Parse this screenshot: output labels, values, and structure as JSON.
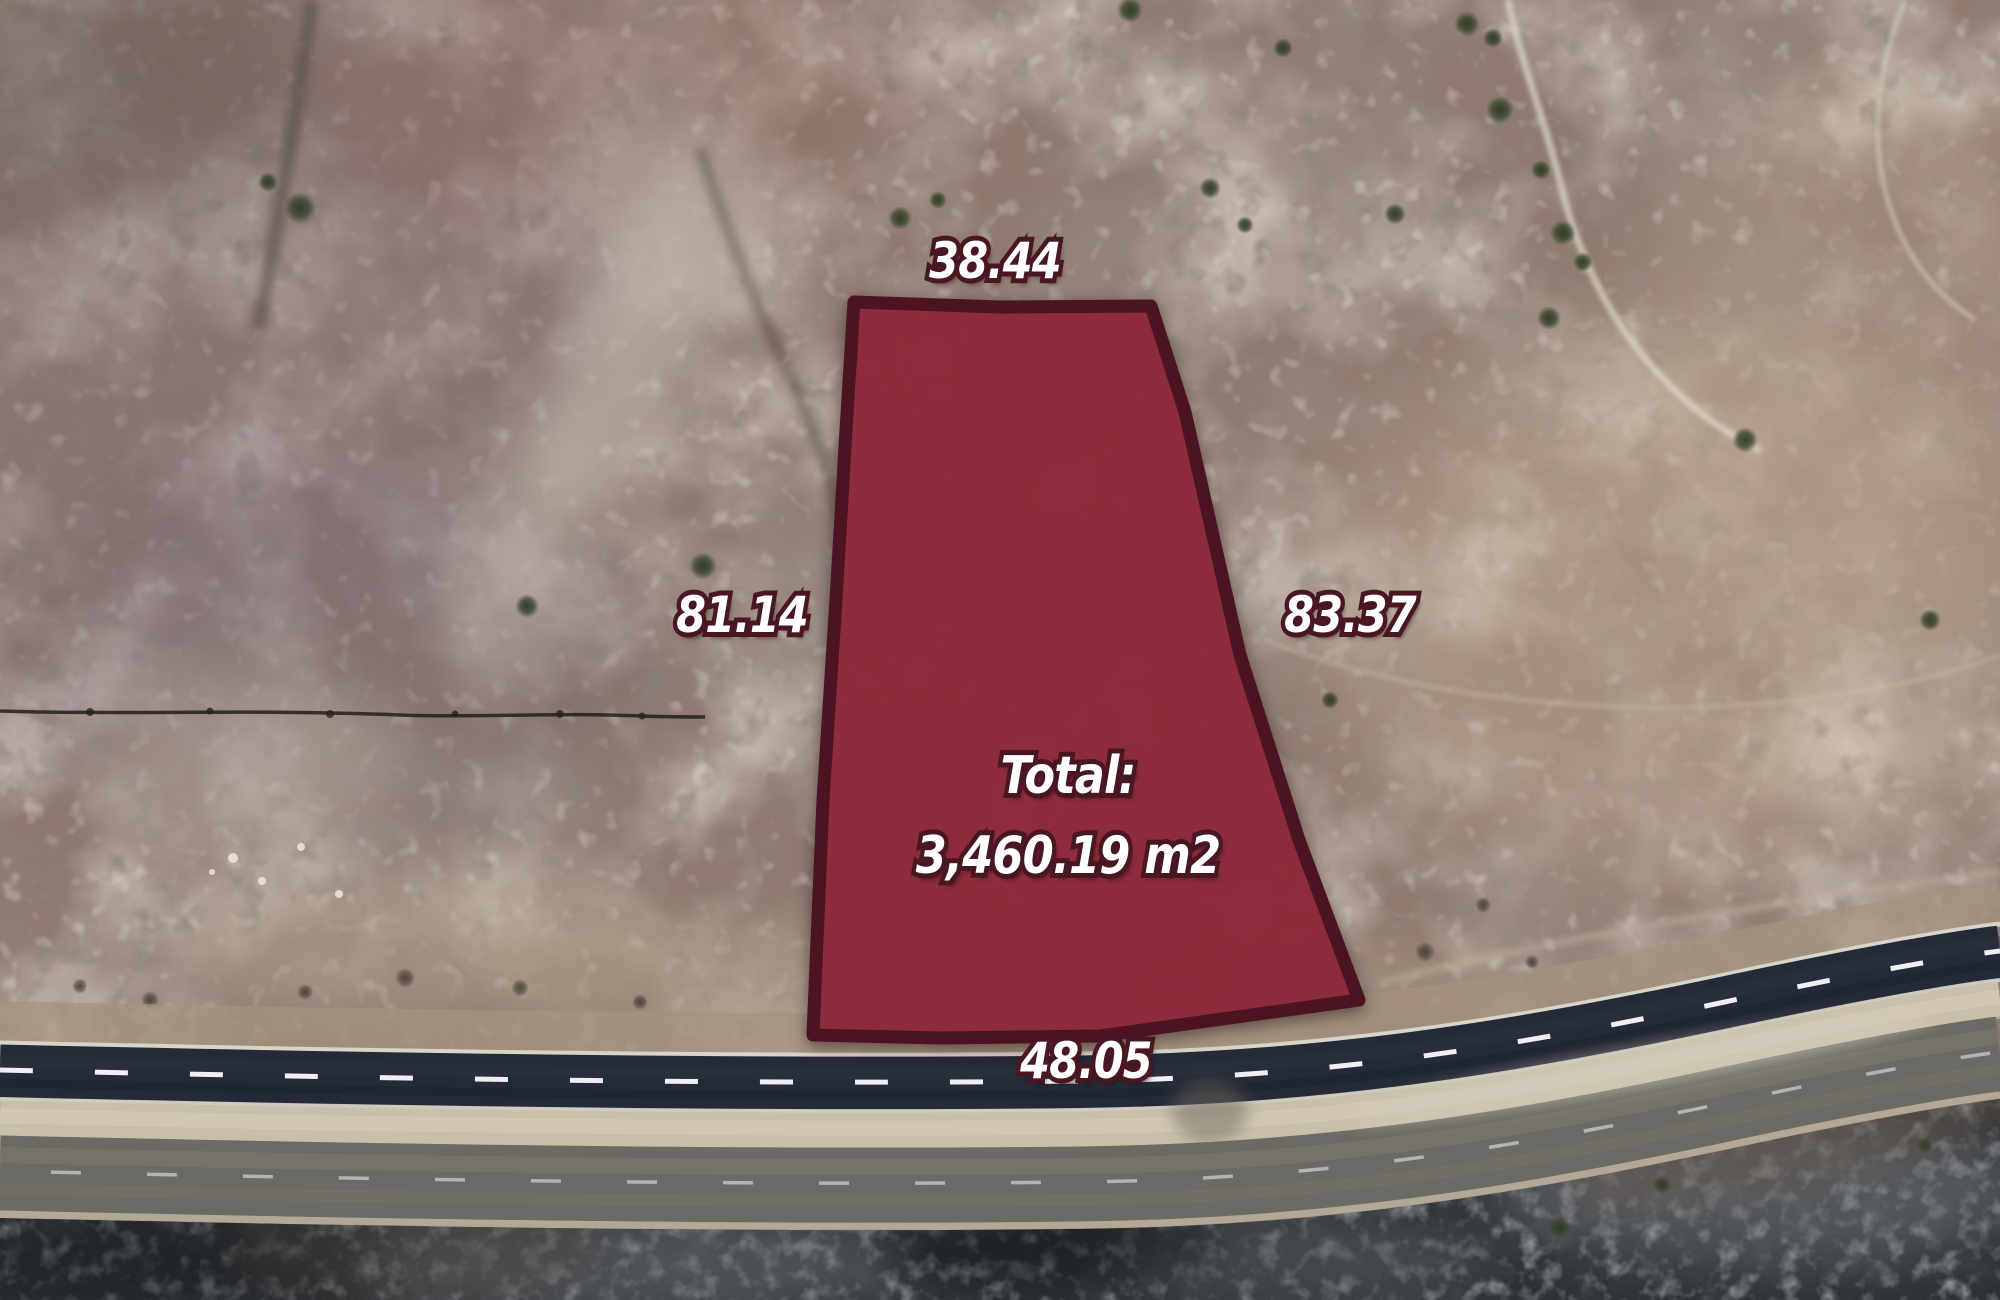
{
  "parcel": {
    "measurements": {
      "top": "38.44",
      "left": "81.14",
      "right": "83.37",
      "bottom": "48.05"
    },
    "total": {
      "label": "Total:",
      "area": "3,460.19 m2"
    },
    "colors": {
      "fill": "#8e2b3c",
      "border": "#4c1420",
      "label_text": "#ffffff",
      "label_outline": "#491722"
    }
  }
}
